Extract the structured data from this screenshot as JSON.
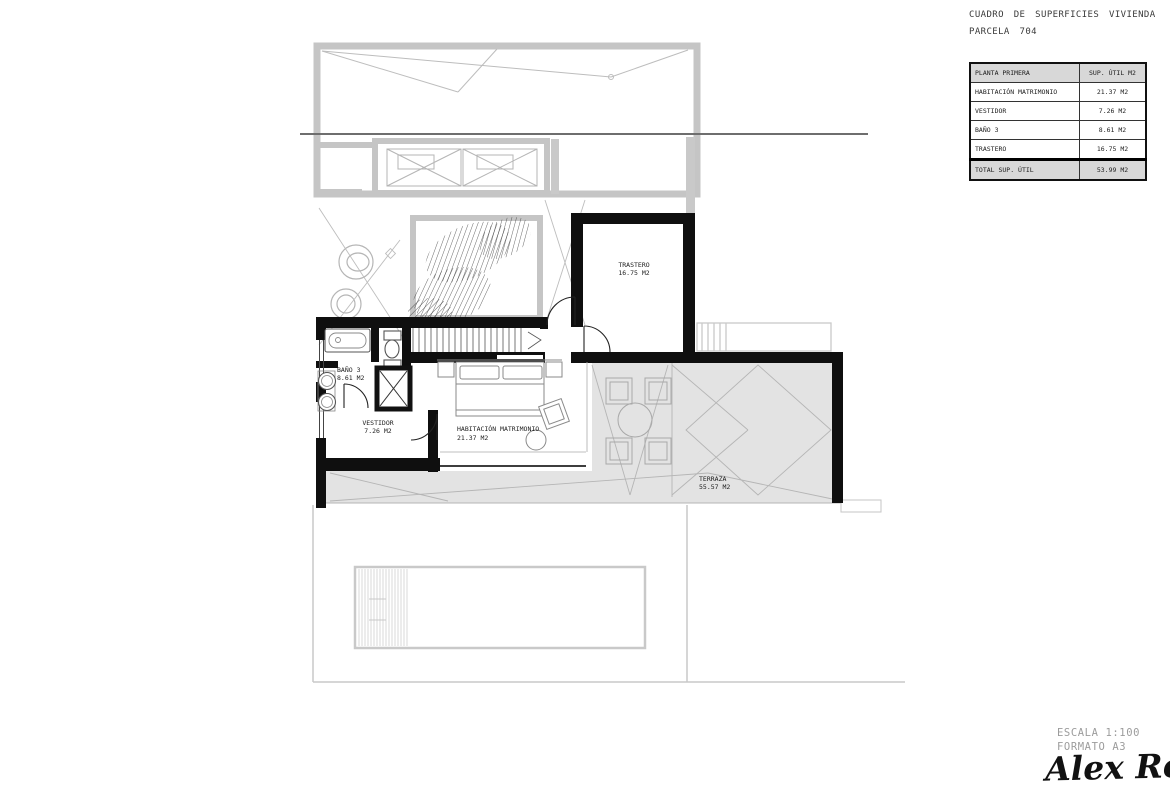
{
  "title_block": {
    "line1": "CUADRO DE SUPERFICIES VIVIENDA",
    "line2": "PARCELA 704"
  },
  "area_table": {
    "header": {
      "col1": "PLANTA PRIMERA",
      "col2": "SUP. ÚTIL M2"
    },
    "rows": [
      {
        "name": "HABITACIÓN MATRIMONIO",
        "value": "21.37 M2"
      },
      {
        "name": "VESTIDOR",
        "value": "7.26 M2"
      },
      {
        "name": "BAÑO 3",
        "value": "8.61 M2"
      },
      {
        "name": "TRASTERO",
        "value": "16.75 M2"
      }
    ],
    "total": {
      "name": "TOTAL SUP. ÚTIL",
      "value": "53.99 M2"
    }
  },
  "plan_labels": {
    "trastero": {
      "name": "TRASTERO",
      "area": "16.75 M2"
    },
    "bano3": {
      "name": "BAÑO 3",
      "area": "8.61 M2"
    },
    "vestidor": {
      "name": "VESTIDOR",
      "area": "7.26 M2"
    },
    "habitacion": {
      "name": "HABITACIÓN MATRIMONIO",
      "area": "21.37 M2"
    },
    "terraza": {
      "name": "TERRAZA",
      "area": "55.57 M2"
    }
  },
  "footer": {
    "scale": "ESCALA 1:100",
    "format": "FORMATO A3",
    "signature": "Alex Ros"
  },
  "colors": {
    "wall_black": "#0f0f0f",
    "lower_floor_gray": "#c5c5c5",
    "terrace_fill": "#e3e3e3",
    "thin_line_gray": "#b5b5b5",
    "table_header_bg": "#d8d8d8",
    "footer_text": "#9c9c9c",
    "section_line": "#6e6e6e"
  }
}
